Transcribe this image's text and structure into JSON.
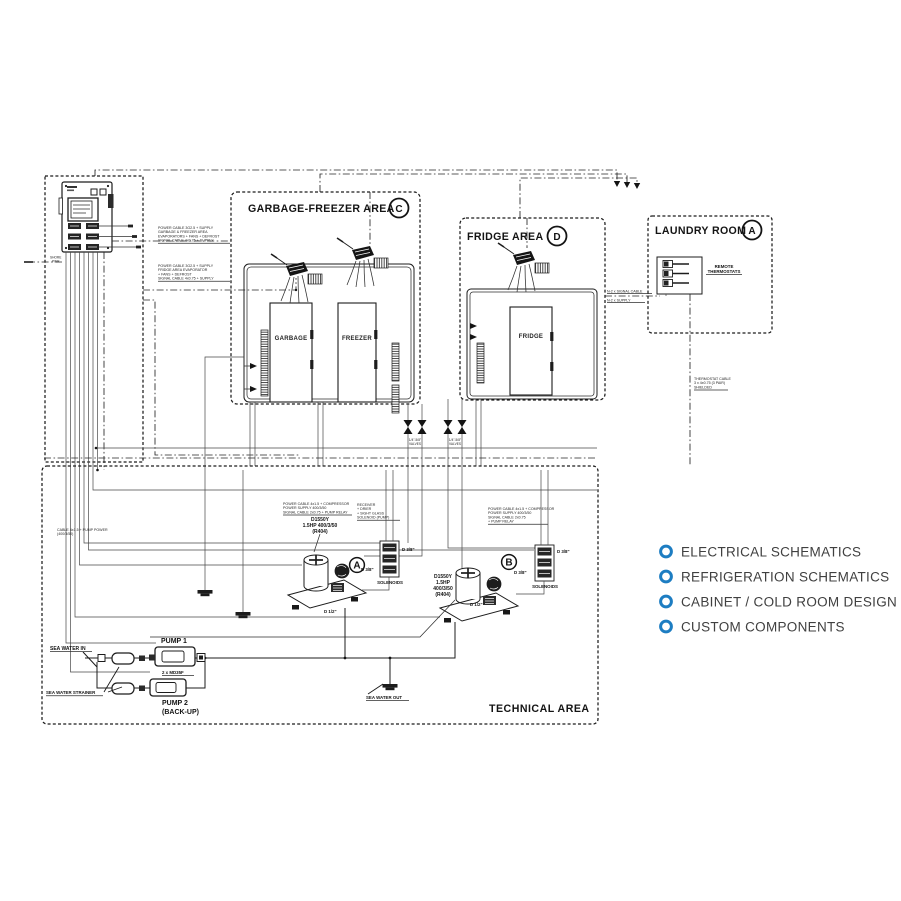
{
  "menu": {
    "bullet_color": "#1d7dc2",
    "text_color": "#404040",
    "items": [
      {
        "label": "ELECTRICAL SCHEMATICS"
      },
      {
        "label": "REFRIGERATION SCHEMATICS"
      },
      {
        "label": "CABINET / COLD ROOM DESIGN"
      },
      {
        "label": "CUSTOM COMPONENTS"
      }
    ]
  },
  "areas": {
    "garbage_freezer": {
      "title": "GARBAGE-FREEZER AREA",
      "tag": "C"
    },
    "fridge": {
      "title": "FRIDGE AREA",
      "tag": "D"
    },
    "laundry": {
      "title": "LAUNDRY ROOM",
      "tag": "A"
    },
    "technical": {
      "title": "TECHNICAL AREA"
    }
  },
  "cabinets": {
    "garbage": "GARBAGE",
    "freezer": "FREEZER",
    "fridge": "FRIDGE"
  },
  "equipment": {
    "remote_thermostats_1": "REMOTE",
    "remote_thermostats_2": "THERMOSTATS",
    "compressor_a": {
      "tag": "A",
      "model": "D1550Y",
      "rating": "1.5HP 400/3/50",
      "refrigerant": "(R404)",
      "pipe": "D 1/2\"",
      "solenoid_pipe": "D 3/8\"",
      "solenoids": "SOLENOIDS"
    },
    "compressor_b": {
      "tag": "B",
      "model": "D1550Y",
      "rating": "1.5HP",
      "rating2": "400/3/50",
      "refrigerant": "(R404)",
      "pipe": "D 1/2\"",
      "solenoid_pipe": "D 3/8\"",
      "solenoids": "SOLENOIDS"
    },
    "pump1": {
      "label": "PUMP 1",
      "model": "2 x MD35F"
    },
    "pump2": {
      "label": "PUMP 2",
      "sub": "(BACK-UP)"
    },
    "sea_water_in": "SEA WATER IN",
    "sea_water_out": "SEA WATER OUT",
    "sea_water_strainer": "SEA WATER STRAINER",
    "shore": {
      "l1": "SHORE",
      "l2": "PWR"
    },
    "valves": {
      "l1": "1/4\"-5/8\"",
      "l2": "VALVES"
    }
  },
  "specs": {
    "panel_top": [
      "POWER CABLE 3G2.5 + SUPPLY",
      "GARBAGE & FREEZER AREA",
      "EVAPORATORS + FANS + DEFROST",
      "SIGNAL CABLE 4x0.75 + SUPPLY"
    ],
    "panel_bottom": [
      "POWER CABLE 3G2.5 + SUPPLY",
      "FRIDGE AREA EVAPORATOR",
      "+ FANS + DEFROST",
      "SIGNAL CABLE 4x0.75 + SUPPLY"
    ],
    "pump_power": [
      "CABLE 4x1.5 + PUMP POWER",
      "(400/3/50)"
    ],
    "compr_a": [
      "POWER CABLE 4x1.5 + COMPRESSOR",
      "POWER SUPPLY 400/3/50",
      "SIGNAL CABLE 2x0.75 + PUMP RELAY"
    ],
    "receiver_a": [
      "RECEIVER",
      "+ DRIER",
      "+ SIGHT GLASS",
      "SOLENOID (PUMP)"
    ],
    "compr_b": [
      "POWER CABLE 4x1.5 + COMPRESSOR",
      "POWER SUPPLY 400/3/50",
      "SIGNAL CABLE 2x0.75",
      "+ PUMP RELAY"
    ],
    "laundry_drop": [
      "THERMOSTAT CABLE",
      "3 x 4x0.75 (3 PAIR)",
      "SHIELDED"
    ],
    "fridge_laundry": [
      "N-2 x SIGNAL CABLE",
      "N-2 x SUPPLY"
    ]
  }
}
